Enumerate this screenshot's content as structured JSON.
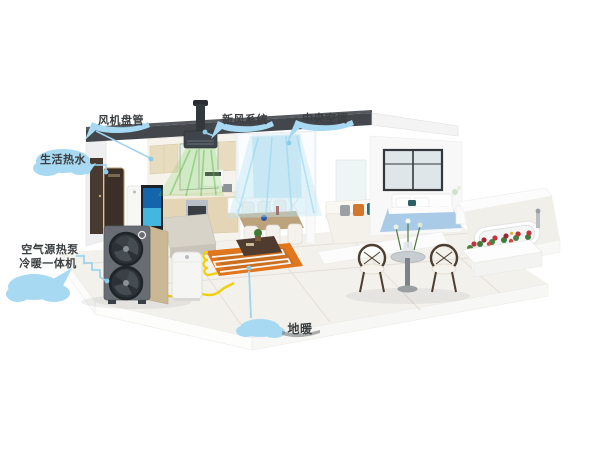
{
  "callouts": {
    "fan_coil": {
      "label": "风机盘管"
    },
    "fresh_air": {
      "label": "新风系统"
    },
    "central_ac": {
      "label": "中央空调"
    },
    "hot_water": {
      "label": "生活热水"
    },
    "heat_pump": {
      "label_line1": "空气源热泵",
      "label_line2": "冷暖一体机"
    },
    "floor_heating": {
      "label": "地暖"
    }
  },
  "colors": {
    "background": "#ffffff",
    "callout_blue": "#a8d9f2",
    "callout_line_blue": "#9fd3ee",
    "label_text": "#3b3e40",
    "pipe_yellow": "#f2cf0a",
    "floor_heating_orange": "#e2761d",
    "fresh_air_green": "#6abf4b",
    "ac_airflow_cyan": "#bfe6f6",
    "ceiling_dark": "#43474c",
    "heat_pump_body": "#686d73",
    "heat_pump_side_gold": "#c9b893"
  },
  "scene_elements": [
    "heat-pump-outdoor-unit",
    "buffer-water-tank",
    "hot-water-cabinet",
    "fresh-air-ceiling-unit",
    "roof-exhaust-pipe",
    "kitchen-cabinets",
    "tv-panel",
    "dining-set",
    "curtain-window",
    "sofa",
    "bedroom-bed",
    "bathtub",
    "balcony-table-set",
    "flower-planter",
    "underfloor-heating-coil",
    "yellow-water-pipes"
  ]
}
